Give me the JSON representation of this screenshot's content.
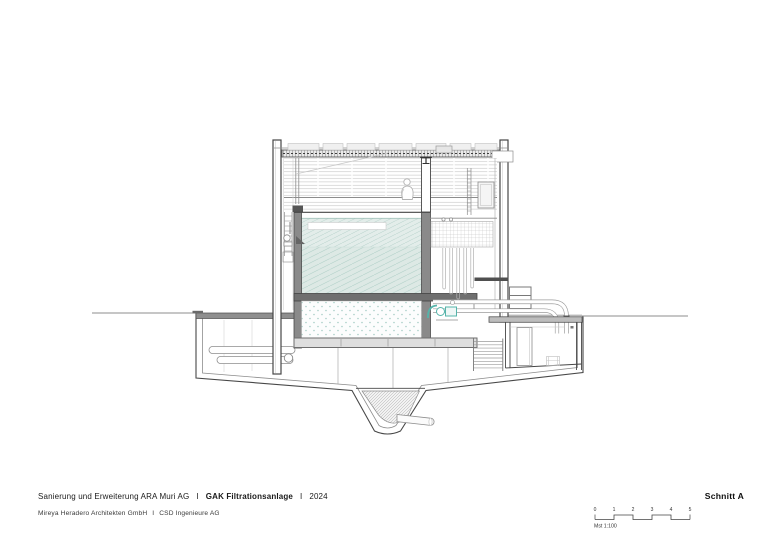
{
  "titleblock": {
    "line1": {
      "project": "Sanierung und Erweiterung ARA Muri AG",
      "sep1": "I",
      "title_bold": "GAK Filtrationsanlage",
      "sep2": "I",
      "year": "2024"
    },
    "line2": {
      "architect": "Mireya Heradero Architekten GmbH",
      "sep": "I",
      "engineer": "CSD Ingenieure AG"
    },
    "drawing_title": "Schnitt A",
    "scale": {
      "label": "Mst 1:100",
      "ticks": [
        "0",
        "1",
        "2",
        "3",
        "4",
        "5"
      ]
    }
  },
  "drawing": {
    "kind": "building-section",
    "colors": {
      "line_dark": "#474747",
      "line_mid": "#8d8d8d",
      "line_light": "#c6c6c6",
      "water_fill": "#e3edea",
      "water_hatch": "#b9d4cd",
      "water_deep_fill": "#dde9e5",
      "stipple_dot": "#a8cec7",
      "slab_dark": "#6f6f6f",
      "equipment_teal": "#54b4aa"
    }
  }
}
